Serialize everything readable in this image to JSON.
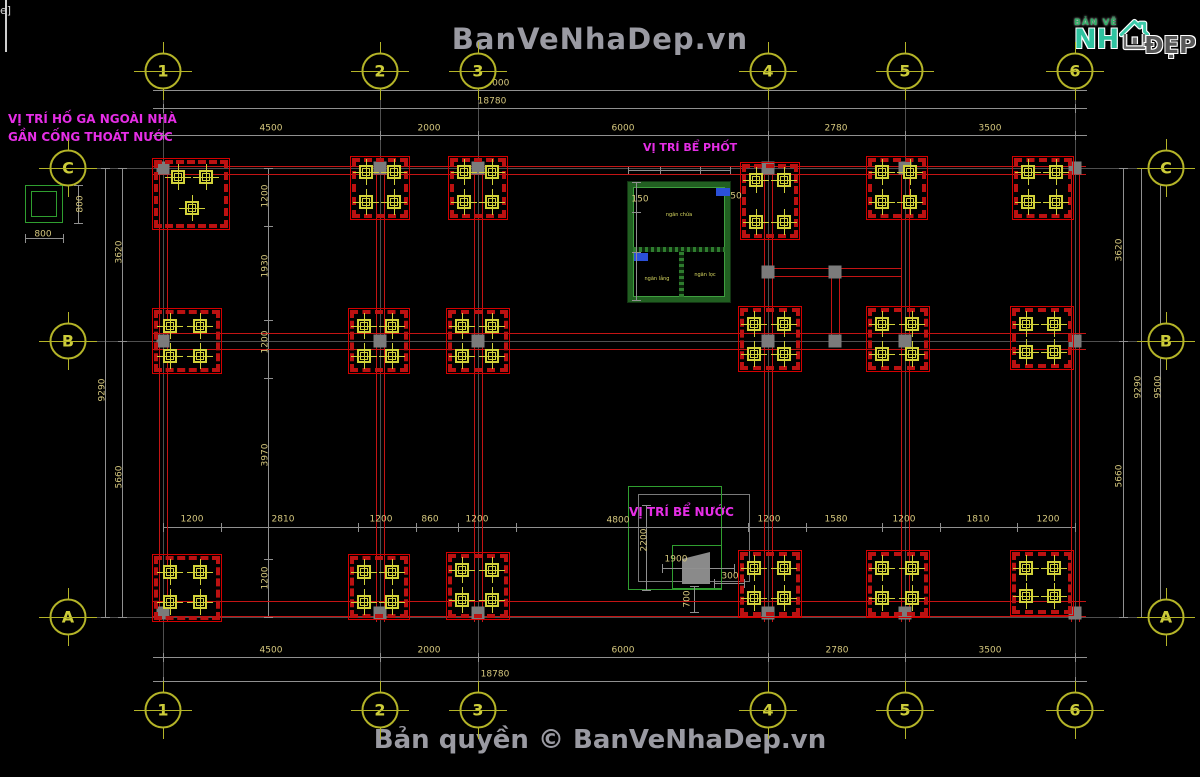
{
  "header": {
    "watermark": "BanVeNhaDep.vn"
  },
  "footer": {
    "copyright": "Bản quyền © BanVeNhaDep.vn"
  },
  "logo": {
    "small": "BẢN VẼ",
    "main": "NH",
    "suffix": "ĐẸP"
  },
  "annotations": {
    "hoga_line1": "VỊ TRÍ HỐ GA NGOÀI NHÀ",
    "hoga_line2": "GẦN CỐNG THOÁT NƯỚC",
    "bephot_title": "VỊ TRÍ BỂ PHỐT",
    "benuoc_title": "VỊ TRÍ BỂ NƯỚC",
    "bephot_chamber1": "ngăn chứa",
    "bephot_chamber2": "ngăn lắng",
    "bephot_chamber3": "ngăn lọc"
  },
  "colors": {
    "background": "#000000",
    "beam_red": "#c41414",
    "grid_gray": "#4f4f4f",
    "dim_gray": "#909090",
    "dim_text": "#d6c87e",
    "bubble": "#b4b428",
    "column_yellow": "#d2d23a",
    "tank_green": "#2f9e2f",
    "annotation_magenta": "#e62ee6",
    "watermark_gray": "#9a9aa2",
    "node_gray": "#7b7b7b",
    "logo_teal": "#2fc3a0"
  },
  "drawing": {
    "bubbles": [
      {
        "l": "1",
        "x": 163,
        "y": 71
      },
      {
        "l": "2",
        "x": 380,
        "y": 71
      },
      {
        "l": "3",
        "x": 478,
        "y": 71
      },
      {
        "l": "4",
        "x": 768,
        "y": 71
      },
      {
        "l": "5",
        "x": 905,
        "y": 71
      },
      {
        "l": "6",
        "x": 1075,
        "y": 71
      },
      {
        "l": "1",
        "x": 163,
        "y": 710
      },
      {
        "l": "2",
        "x": 380,
        "y": 710
      },
      {
        "l": "3",
        "x": 478,
        "y": 710
      },
      {
        "l": "4",
        "x": 768,
        "y": 710
      },
      {
        "l": "5",
        "x": 905,
        "y": 710
      },
      {
        "l": "6",
        "x": 1075,
        "y": 710
      },
      {
        "l": "C",
        "x": 68,
        "y": 168
      },
      {
        "l": "B",
        "x": 68,
        "y": 341
      },
      {
        "l": "A",
        "x": 68,
        "y": 617
      },
      {
        "l": "C",
        "x": 1166,
        "y": 168
      },
      {
        "l": "B",
        "x": 1166,
        "y": 341
      },
      {
        "l": "A",
        "x": 1166,
        "y": 617
      }
    ],
    "gridlines": [
      {
        "o": "v",
        "x": 163,
        "y": 92,
        "len": 610
      },
      {
        "o": "v",
        "x": 380,
        "y": 92,
        "len": 610
      },
      {
        "o": "v",
        "x": 478,
        "y": 92,
        "len": 610
      },
      {
        "o": "v",
        "x": 768,
        "y": 92,
        "len": 610
      },
      {
        "o": "v",
        "x": 905,
        "y": 92,
        "len": 610
      },
      {
        "o": "v",
        "x": 1075,
        "y": 92,
        "len": 610
      },
      {
        "o": "h",
        "x": 88,
        "y": 168,
        "len": 1058
      },
      {
        "o": "h",
        "x": 88,
        "y": 341,
        "len": 1058
      },
      {
        "o": "h",
        "x": 88,
        "y": 617,
        "len": 1058
      }
    ],
    "dimlines": [
      {
        "o": "h",
        "x": 153,
        "y": 90,
        "len": 934,
        "ticks": [
          163,
          1075
        ]
      },
      {
        "o": "h",
        "x": 153,
        "y": 108,
        "len": 934,
        "ticks": [
          163,
          1075
        ]
      },
      {
        "o": "h",
        "x": 153,
        "y": 135,
        "len": 934,
        "ticks": [
          163,
          380,
          478,
          768,
          905,
          1075
        ]
      },
      {
        "o": "h",
        "x": 153,
        "y": 657,
        "len": 934,
        "ticks": [
          163,
          380,
          478,
          768,
          905,
          1075
        ]
      },
      {
        "o": "h",
        "x": 153,
        "y": 681,
        "len": 934,
        "ticks": [
          163,
          1075
        ]
      },
      {
        "o": "h",
        "x": 163,
        "y": 527,
        "len": 912,
        "ticks": [
          163,
          221,
          358,
          416,
          458,
          516,
          748,
          806,
          882,
          940,
          1017,
          1075
        ]
      },
      {
        "o": "v",
        "x": 105,
        "y": 168,
        "len": 449,
        "ticks": [
          168,
          617
        ]
      },
      {
        "o": "v",
        "x": 122,
        "y": 168,
        "len": 449,
        "ticks": [
          168,
          341,
          617
        ]
      },
      {
        "o": "v",
        "x": 1123,
        "y": 168,
        "len": 449,
        "ticks": [
          168,
          341,
          617
        ]
      },
      {
        "o": "v",
        "x": 1141,
        "y": 168,
        "len": 449,
        "ticks": [
          168,
          617
        ]
      },
      {
        "o": "v",
        "x": 1160,
        "y": 168,
        "len": 449,
        "ticks": [
          168,
          617
        ]
      },
      {
        "o": "v",
        "x": 268,
        "y": 168,
        "len": 449,
        "ticks": [
          168,
          226,
          320,
          378,
          559,
          617
        ]
      },
      {
        "o": "v",
        "x": 646,
        "y": 505,
        "len": 85,
        "ticks": [
          505,
          590
        ]
      },
      {
        "o": "h",
        "x": 662,
        "y": 568,
        "len": 72,
        "ticks": [
          662,
          734
        ]
      },
      {
        "o": "h",
        "x": 714,
        "y": 583,
        "len": 30,
        "ticks": [
          714,
          744
        ]
      },
      {
        "o": "v",
        "x": 694,
        "y": 586,
        "len": 26,
        "ticks": [
          586,
          612
        ]
      },
      {
        "o": "v",
        "x": 78,
        "y": 185,
        "len": 38,
        "ticks": [
          185,
          223
        ]
      },
      {
        "o": "h",
        "x": 25,
        "y": 238,
        "len": 38,
        "ticks": [
          25,
          63
        ]
      },
      {
        "o": "v",
        "x": 636,
        "y": 182,
        "len": 118,
        "ticks": [
          182,
          212,
          252,
          300
        ]
      },
      {
        "o": "h",
        "x": 628,
        "y": 170,
        "len": 102,
        "ticks": [
          628,
          660,
          700,
          730
        ]
      }
    ],
    "redlines": [
      [
        159,
        162,
        1,
        460
      ],
      [
        167,
        162,
        1,
        460
      ],
      [
        376,
        162,
        1,
        460
      ],
      [
        384,
        162,
        1,
        460
      ],
      [
        474,
        162,
        1,
        460
      ],
      [
        482,
        162,
        1,
        460
      ],
      [
        764,
        162,
        1,
        460
      ],
      [
        772,
        162,
        1,
        460
      ],
      [
        901,
        162,
        1,
        460
      ],
      [
        909,
        162,
        1,
        460
      ],
      [
        1071,
        162,
        1,
        460
      ],
      [
        1079,
        162,
        1,
        460
      ],
      [
        152,
        166,
        934,
        1
      ],
      [
        152,
        174,
        934,
        1
      ],
      [
        152,
        333,
        934,
        1
      ],
      [
        152,
        349,
        934,
        1
      ],
      [
        152,
        601,
        934,
        1
      ],
      [
        152,
        616,
        934,
        1
      ],
      [
        764,
        268,
        138,
        1
      ],
      [
        764,
        276,
        138,
        1
      ],
      [
        831,
        268,
        1,
        77
      ],
      [
        839,
        268,
        1,
        77
      ]
    ],
    "nodes": [
      [
        163,
        168
      ],
      [
        380,
        168
      ],
      [
        478,
        168
      ],
      [
        768,
        168
      ],
      [
        905,
        168
      ],
      [
        1075,
        168
      ],
      [
        163,
        341
      ],
      [
        380,
        341
      ],
      [
        478,
        341
      ],
      [
        768,
        341
      ],
      [
        835,
        341
      ],
      [
        905,
        341
      ],
      [
        1075,
        341
      ],
      [
        163,
        613
      ],
      [
        380,
        613
      ],
      [
        478,
        613
      ],
      [
        768,
        613
      ],
      [
        905,
        613
      ],
      [
        1075,
        613
      ],
      [
        768,
        272
      ],
      [
        835,
        272
      ]
    ],
    "footings": [
      {
        "x": 152,
        "y": 158,
        "w": 78,
        "h": 72,
        "cols": [
          [
            178,
            177
          ],
          [
            206,
            177
          ],
          [
            192,
            208
          ]
        ]
      },
      {
        "x": 350,
        "y": 156,
        "w": 60,
        "h": 64,
        "cols": [
          [
            366,
            172
          ],
          [
            394,
            172
          ],
          [
            366,
            202
          ],
          [
            394,
            202
          ]
        ]
      },
      {
        "x": 448,
        "y": 156,
        "w": 60,
        "h": 64,
        "cols": [
          [
            464,
            172
          ],
          [
            492,
            172
          ],
          [
            464,
            202
          ],
          [
            492,
            202
          ]
        ]
      },
      {
        "x": 740,
        "y": 162,
        "w": 60,
        "h": 78,
        "cols": [
          [
            756,
            180
          ],
          [
            784,
            180
          ],
          [
            756,
            222
          ],
          [
            784,
            222
          ]
        ]
      },
      {
        "x": 866,
        "y": 156,
        "w": 62,
        "h": 64,
        "cols": [
          [
            882,
            172
          ],
          [
            910,
            172
          ],
          [
            882,
            202
          ],
          [
            910,
            202
          ]
        ]
      },
      {
        "x": 1012,
        "y": 156,
        "w": 62,
        "h": 64,
        "cols": [
          [
            1028,
            172
          ],
          [
            1056,
            172
          ],
          [
            1028,
            202
          ],
          [
            1056,
            202
          ]
        ]
      },
      {
        "x": 152,
        "y": 308,
        "w": 70,
        "h": 66,
        "cols": [
          [
            170,
            326
          ],
          [
            200,
            326
          ],
          [
            170,
            356
          ],
          [
            200,
            356
          ]
        ]
      },
      {
        "x": 348,
        "y": 308,
        "w": 62,
        "h": 66,
        "cols": [
          [
            364,
            326
          ],
          [
            392,
            326
          ],
          [
            364,
            356
          ],
          [
            392,
            356
          ]
        ]
      },
      {
        "x": 446,
        "y": 308,
        "w": 64,
        "h": 66,
        "cols": [
          [
            462,
            326
          ],
          [
            492,
            326
          ],
          [
            462,
            356
          ],
          [
            492,
            356
          ]
        ]
      },
      {
        "x": 738,
        "y": 306,
        "w": 64,
        "h": 66,
        "cols": [
          [
            754,
            324
          ],
          [
            784,
            324
          ],
          [
            754,
            354
          ],
          [
            784,
            354
          ]
        ]
      },
      {
        "x": 866,
        "y": 306,
        "w": 64,
        "h": 66,
        "cols": [
          [
            882,
            324
          ],
          [
            912,
            324
          ],
          [
            882,
            354
          ],
          [
            912,
            354
          ]
        ]
      },
      {
        "x": 1010,
        "y": 306,
        "w": 64,
        "h": 64,
        "cols": [
          [
            1026,
            324
          ],
          [
            1054,
            324
          ],
          [
            1026,
            352
          ],
          [
            1054,
            352
          ]
        ]
      },
      {
        "x": 152,
        "y": 554,
        "w": 70,
        "h": 68,
        "cols": [
          [
            170,
            572
          ],
          [
            200,
            572
          ],
          [
            170,
            602
          ],
          [
            200,
            602
          ]
        ]
      },
      {
        "x": 348,
        "y": 554,
        "w": 62,
        "h": 66,
        "cols": [
          [
            364,
            572
          ],
          [
            392,
            572
          ],
          [
            364,
            602
          ],
          [
            392,
            602
          ]
        ]
      },
      {
        "x": 446,
        "y": 552,
        "w": 64,
        "h": 68,
        "cols": [
          [
            462,
            570
          ],
          [
            492,
            570
          ],
          [
            462,
            600
          ],
          [
            492,
            600
          ]
        ]
      },
      {
        "x": 738,
        "y": 550,
        "w": 64,
        "h": 68,
        "cols": [
          [
            754,
            568
          ],
          [
            784,
            568
          ],
          [
            754,
            598
          ],
          [
            784,
            598
          ]
        ]
      },
      {
        "x": 866,
        "y": 550,
        "w": 64,
        "h": 68,
        "cols": [
          [
            882,
            568
          ],
          [
            912,
            568
          ],
          [
            882,
            598
          ],
          [
            912,
            598
          ]
        ]
      },
      {
        "x": 1010,
        "y": 550,
        "w": 64,
        "h": 66,
        "cols": [
          [
            1026,
            568
          ],
          [
            1054,
            568
          ],
          [
            1026,
            596
          ],
          [
            1054,
            596
          ]
        ]
      }
    ],
    "dimtexts": [
      {
        "t": "19000",
        "x": 495,
        "y": 84
      },
      {
        "t": "18780",
        "x": 492,
        "y": 102
      },
      {
        "t": "4500",
        "x": 271,
        "y": 129
      },
      {
        "t": "2000",
        "x": 429,
        "y": 129
      },
      {
        "t": "6000",
        "x": 623,
        "y": 129
      },
      {
        "t": "2780",
        "x": 836,
        "y": 129
      },
      {
        "t": "3500",
        "x": 990,
        "y": 129
      },
      {
        "t": "4500",
        "x": 271,
        "y": 651
      },
      {
        "t": "2000",
        "x": 429,
        "y": 651
      },
      {
        "t": "6000",
        "x": 623,
        "y": 651
      },
      {
        "t": "2780",
        "x": 837,
        "y": 651
      },
      {
        "t": "3500",
        "x": 990,
        "y": 651
      },
      {
        "t": "18780",
        "x": 495,
        "y": 675
      },
      {
        "t": "9290",
        "x": 103,
        "y": 390,
        "r": 1
      },
      {
        "t": "3620",
        "x": 120,
        "y": 252,
        "r": 1
      },
      {
        "t": "5660",
        "x": 120,
        "y": 477,
        "r": 1
      },
      {
        "t": "3620",
        "x": 1120,
        "y": 250,
        "r": 1
      },
      {
        "t": "5660",
        "x": 1120,
        "y": 476,
        "r": 1
      },
      {
        "t": "9290",
        "x": 1139,
        "y": 387,
        "r": 1
      },
      {
        "t": "9500",
        "x": 1159,
        "y": 387,
        "r": 1
      },
      {
        "t": "1200",
        "x": 192,
        "y": 520
      },
      {
        "t": "2810",
        "x": 283,
        "y": 520
      },
      {
        "t": "1200",
        "x": 381,
        "y": 520
      },
      {
        "t": "860",
        "x": 430,
        "y": 520
      },
      {
        "t": "1200",
        "x": 477,
        "y": 520
      },
      {
        "t": "4800",
        "x": 618,
        "y": 521
      },
      {
        "t": "1200",
        "x": 769,
        "y": 520
      },
      {
        "t": "1580",
        "x": 836,
        "y": 520
      },
      {
        "t": "1200",
        "x": 904,
        "y": 520
      },
      {
        "t": "1810",
        "x": 978,
        "y": 520
      },
      {
        "t": "1200",
        "x": 1048,
        "y": 520
      },
      {
        "t": "1200",
        "x": 266,
        "y": 196,
        "r": 1
      },
      {
        "t": "1930",
        "x": 266,
        "y": 266,
        "r": 1
      },
      {
        "t": "1200",
        "x": 266,
        "y": 342,
        "r": 1
      },
      {
        "t": "3970",
        "x": 266,
        "y": 455,
        "r": 1
      },
      {
        "t": "1200",
        "x": 266,
        "y": 578,
        "r": 1
      },
      {
        "t": "2200",
        "x": 645,
        "y": 540,
        "r": 1
      },
      {
        "t": "1900",
        "x": 676,
        "y": 560
      },
      {
        "t": "300",
        "x": 730,
        "y": 577
      },
      {
        "t": "700",
        "x": 688,
        "y": 599,
        "r": 1
      },
      {
        "t": "800",
        "x": 81,
        "y": 204,
        "r": 1
      },
      {
        "t": "800",
        "x": 43,
        "y": 235
      },
      {
        "t": "150",
        "x": 640,
        "y": 200
      },
      {
        "t": "50",
        "x": 736,
        "y": 197
      }
    ]
  }
}
